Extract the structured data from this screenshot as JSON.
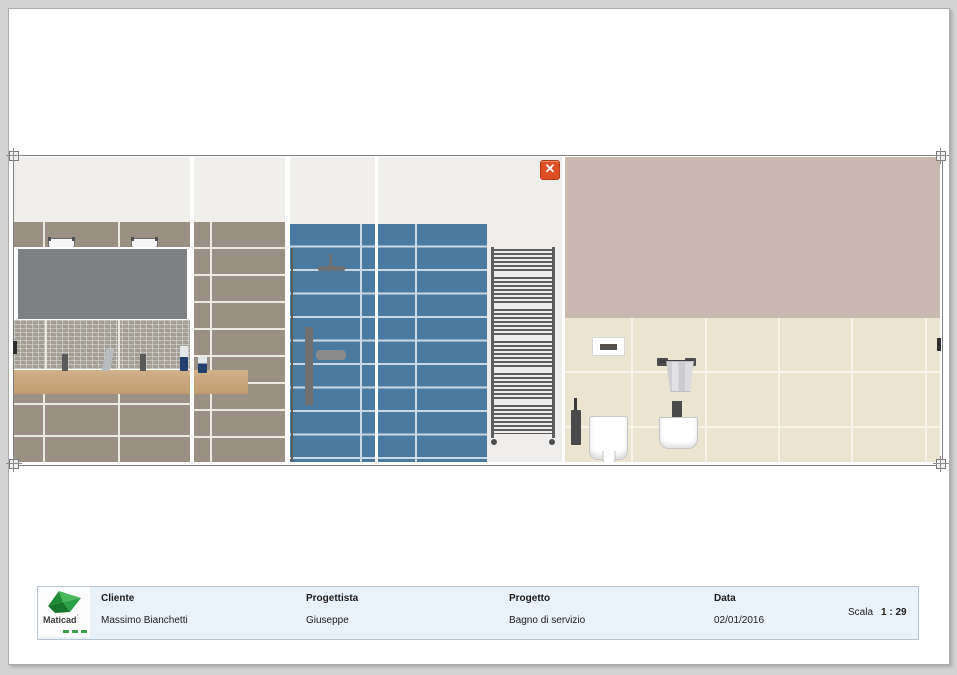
{
  "title_block": {
    "logo_text": "Maticad",
    "logo_mark": "’",
    "columns": [
      {
        "label": "Cliente",
        "value": "Massimo Bianchetti"
      },
      {
        "label": "Progettista",
        "value": "Giuseppe"
      },
      {
        "label": "Progetto",
        "value": "Bagno di servizio"
      },
      {
        "label": "Data",
        "value": "02/01/2016"
      }
    ],
    "scale_label": "Scala",
    "scale_value": "1 : 29"
  },
  "close_button": {
    "icon": "✕"
  },
  "colors": {
    "accent_orange": "#dd4f22",
    "blue_tile": "#4b7aa1",
    "taupe_tile": "#9a9083",
    "mauve_wall": "#c7b8b0",
    "cream_tile": "#ebe4d1",
    "upper_wall": "#f0efec",
    "title_block_bg": "#e9f1f9",
    "logo_green": "#3aa24c"
  }
}
